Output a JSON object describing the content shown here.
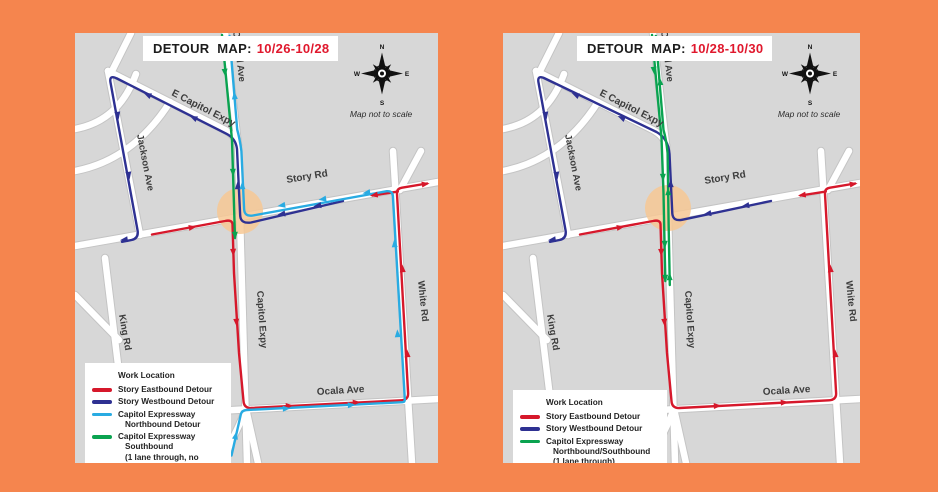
{
  "page": {
    "background": "#F5854E"
  },
  "colors": {
    "map_bg": "#D7D7D7",
    "road": "#FFFFFF",
    "work_location": "#F7C894",
    "story_eastbound": "#D6182B",
    "story_westbound": "#2E3192",
    "capitol_northbound": "#29ABE2",
    "capitol_southbound": "#0AA350",
    "title_dates_red": "#E0182D"
  },
  "panels": [
    {
      "title_prefix": "DETOUR  MAP:",
      "title_dates": "10/26-10/28",
      "map_note": "Map not to scale",
      "compass": {
        "n": "N",
        "e": "E",
        "s": "S",
        "w": "W"
      },
      "road_labels": {
        "e_capitol_expy": "E Capitol Expy",
        "capitol_ave": "Capitol Ave",
        "jackson_ave": "Jackson Ave",
        "story_rd": "Story Rd",
        "king_rd": "King Rd",
        "capitol_expy": "Capitol Expy",
        "white_rd": "White Rd",
        "ocala_ave": "Ocala Ave"
      },
      "legend": {
        "items": [
          {
            "key": "work-location",
            "lines": [
              "Work Location"
            ]
          },
          {
            "key": "story-eastbound",
            "lines": [
              "Story Eastbound Detour"
            ]
          },
          {
            "key": "story-westbound",
            "lines": [
              "Story Westbound Detour"
            ]
          },
          {
            "key": "capitol-northbound",
            "lines": [
              "Capitol Expressway",
              "Northbound Detour"
            ]
          },
          {
            "key": "capitol-southbound",
            "lines": [
              "Capitol Expressway",
              "Southbound",
              "(1 lane through, no detour)"
            ]
          }
        ]
      }
    },
    {
      "title_prefix": "DETOUR  MAP:",
      "title_dates": "10/28-10/30",
      "map_note": "Map not to scale",
      "compass": {
        "n": "N",
        "e": "E",
        "s": "S",
        "w": "W"
      },
      "road_labels": {
        "e_capitol_expy": "E Capitol Expy",
        "capitol_ave": "Capitol Ave",
        "jackson_ave": "Jackson Ave",
        "story_rd": "Story Rd",
        "king_rd": "King Rd",
        "capitol_expy": "Capitol Expy",
        "white_rd": "White Rd",
        "ocala_ave": "Ocala Ave"
      },
      "legend": {
        "items": [
          {
            "key": "work-location",
            "lines": [
              "Work Location"
            ]
          },
          {
            "key": "story-eastbound",
            "lines": [
              "Story Eastbound Detour"
            ]
          },
          {
            "key": "story-westbound",
            "lines": [
              "Story Westbound Detour"
            ]
          },
          {
            "key": "capitol-north-south",
            "lines": [
              "Capitol Expressway",
              "Northbound/Southbound",
              "(1 lane through)"
            ]
          }
        ]
      }
    }
  ]
}
